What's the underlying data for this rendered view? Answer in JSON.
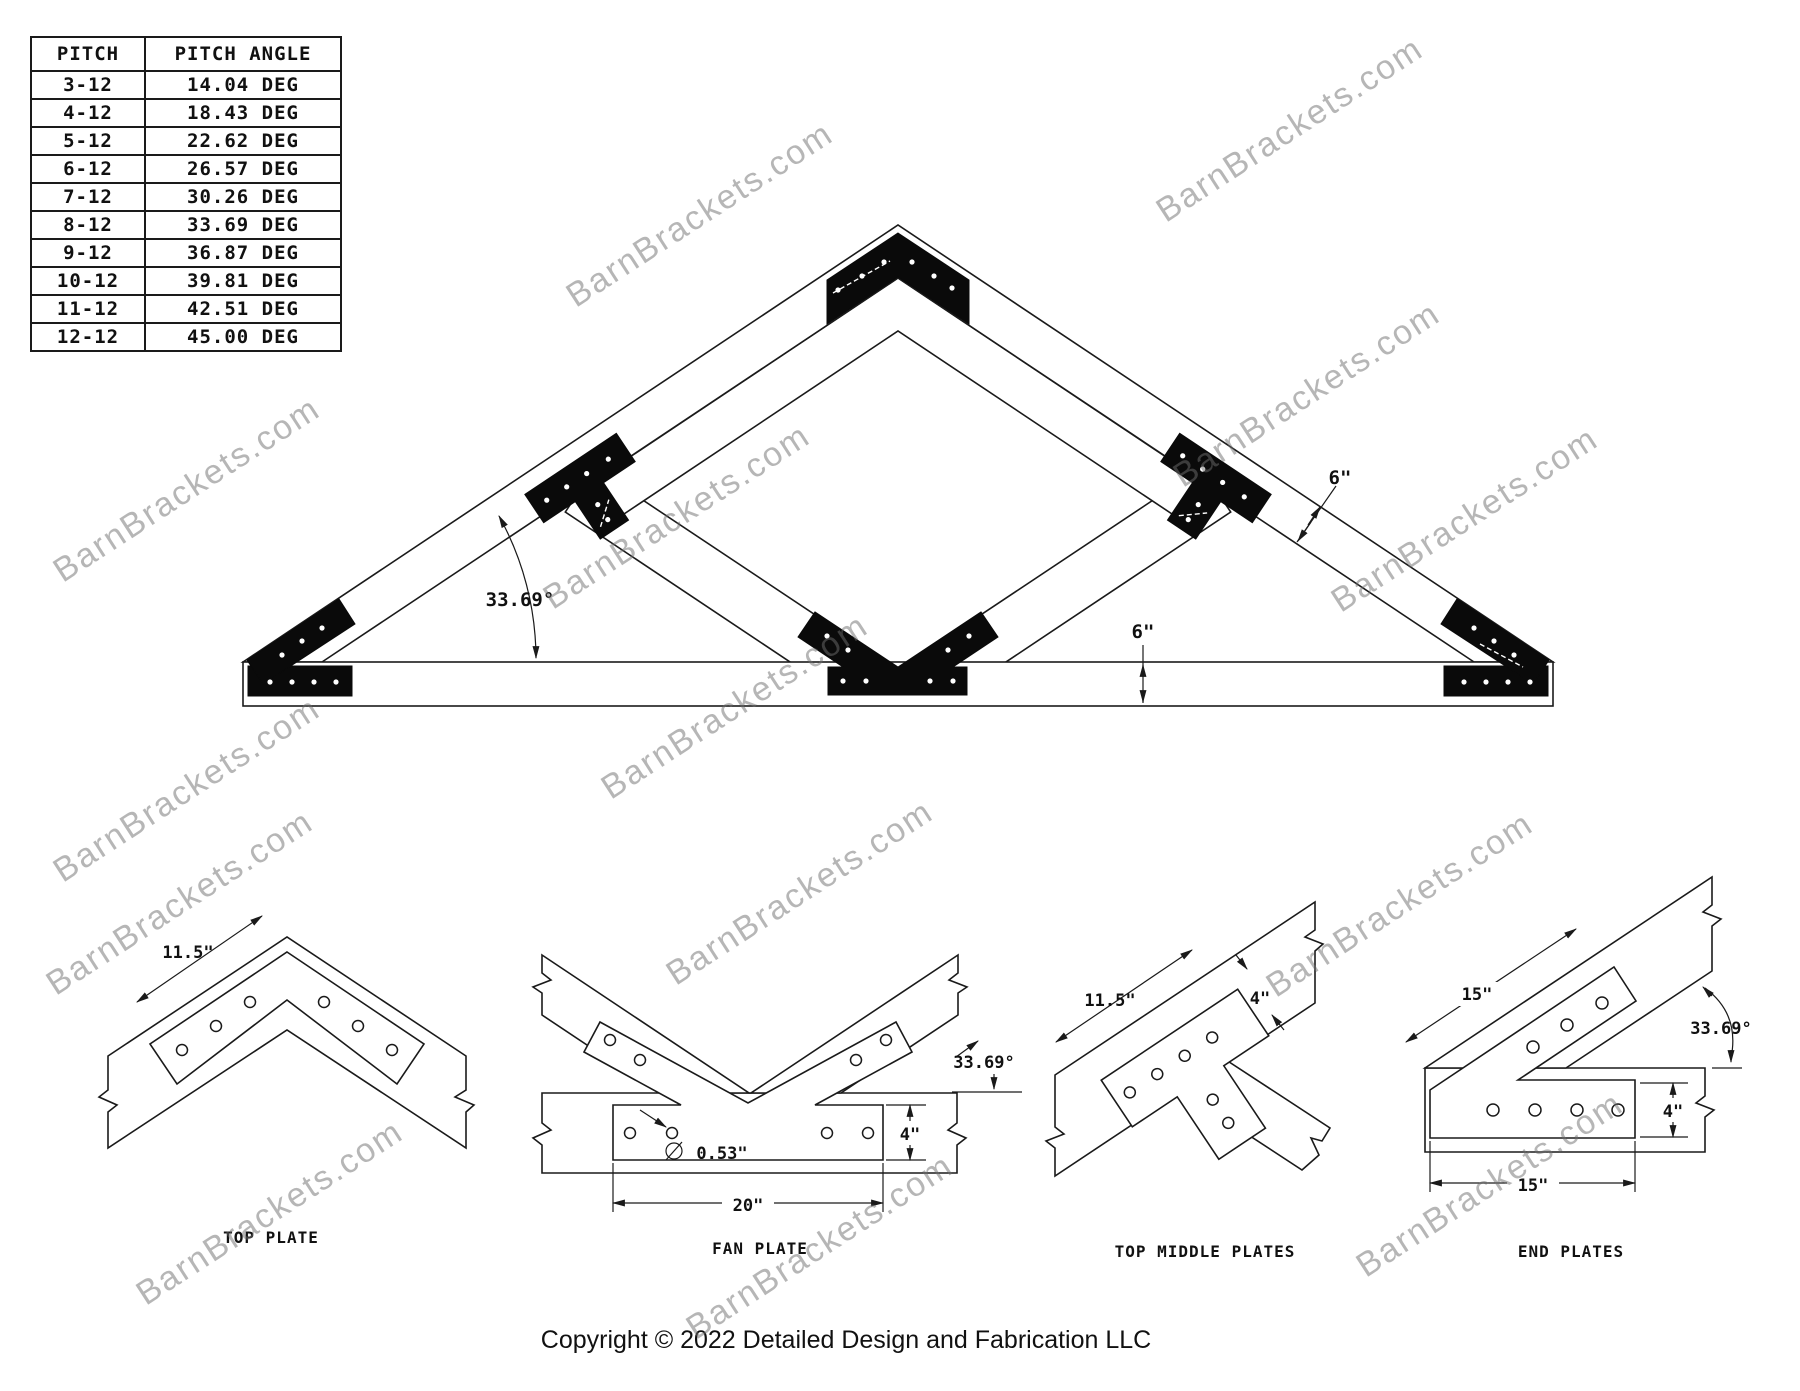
{
  "pitch_table": {
    "headers": [
      "PITCH",
      "PITCH ANGLE"
    ],
    "rows": [
      [
        "3-12",
        "14.04 DEG"
      ],
      [
        "4-12",
        "18.43 DEG"
      ],
      [
        "5-12",
        "22.62 DEG"
      ],
      [
        "6-12",
        "26.57 DEG"
      ],
      [
        "7-12",
        "30.26 DEG"
      ],
      [
        "8-12",
        "33.69 DEG"
      ],
      [
        "9-12",
        "36.87 DEG"
      ],
      [
        "10-12",
        "39.81 DEG"
      ],
      [
        "11-12",
        "42.51 DEG"
      ],
      [
        "12-12",
        "45.00 DEG"
      ]
    ]
  },
  "truss": {
    "angle": "33.69°",
    "rafter_width": "6\"",
    "chord_height": "6\""
  },
  "details": {
    "top_plate": {
      "dim": "11.5\"",
      "label": "TOP PLATE"
    },
    "fan_plate": {
      "width": "20\"",
      "height": "4\"",
      "diameter": "0.53\"",
      "angle": "33.69°",
      "label": "FAN PLATE"
    },
    "top_middle": {
      "length": "11.5\"",
      "width": "4\"",
      "label": "TOP MIDDLE PLATES"
    },
    "end_plates": {
      "top": "15\"",
      "bottom": "15\"",
      "height": "4\"",
      "angle": "33.69°",
      "label": "END PLATES"
    }
  },
  "watermark": {
    "text": "BarnBrackets.com",
    "positions": [
      [
        700,
        215
      ],
      [
        1290,
        130
      ],
      [
        1307,
        395
      ],
      [
        1465,
        520
      ],
      [
        187,
        490
      ],
      [
        677,
        517
      ],
      [
        187,
        790
      ],
      [
        735,
        707
      ],
      [
        180,
        903
      ],
      [
        800,
        893
      ],
      [
        1400,
        905
      ],
      [
        270,
        1213
      ],
      [
        820,
        1247
      ],
      [
        1490,
        1185
      ]
    ]
  },
  "footer": {
    "copyright": "Copyright © 2022 Detailed Design and Fabrication LLC"
  }
}
